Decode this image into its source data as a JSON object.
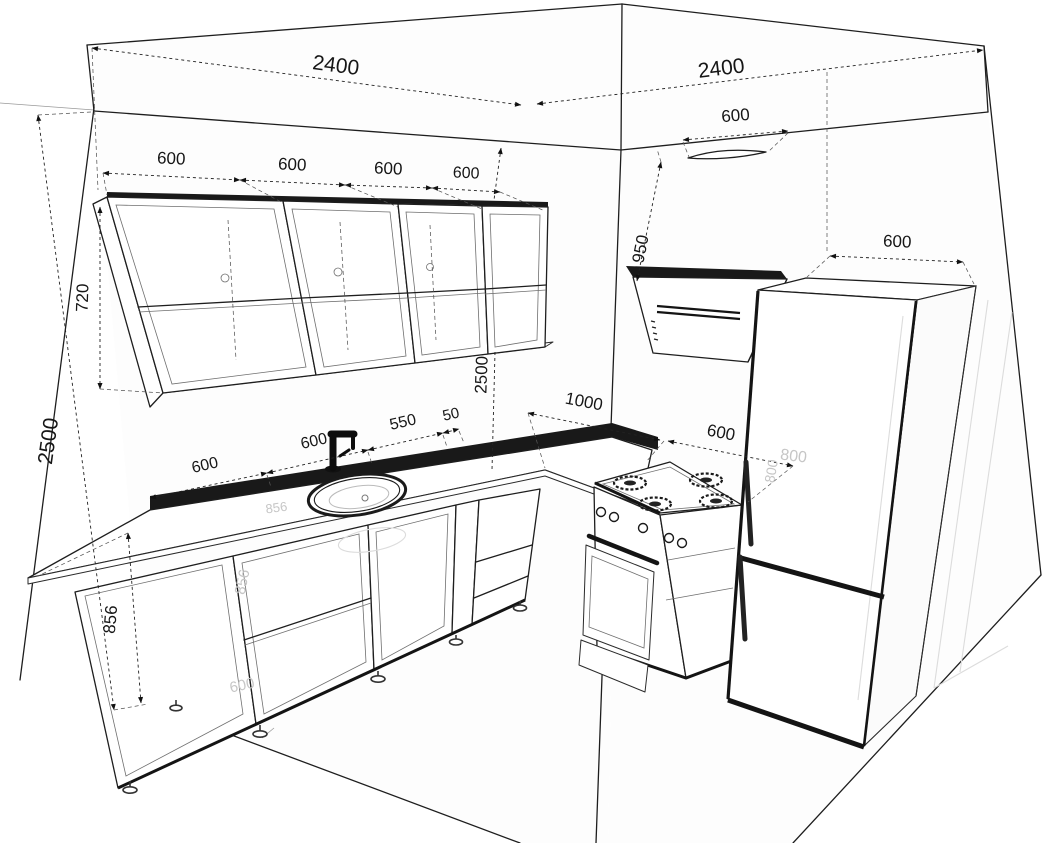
{
  "dims": {
    "left_wall_top": "2400",
    "right_wall_top": "2400",
    "upper": [
      "600",
      "600",
      "600",
      "600"
    ],
    "upper_height": "720",
    "left_wall_height": "2500",
    "base_height": "856",
    "counter": [
      "600",
      "600",
      "550",
      "50"
    ],
    "right_run": "1000",
    "stove_width": "600",
    "hood_width": "600",
    "hood_clearance": "950",
    "corner_height": "2500",
    "fridge_width": "600"
  },
  "ghosts": [
    "856",
    "600",
    "856",
    "800",
    "800"
  ],
  "colors": {
    "line": "#1e1e1e",
    "dark_band": "#191919",
    "ghost": "#c6c6c6",
    "background": "#ffffff"
  }
}
